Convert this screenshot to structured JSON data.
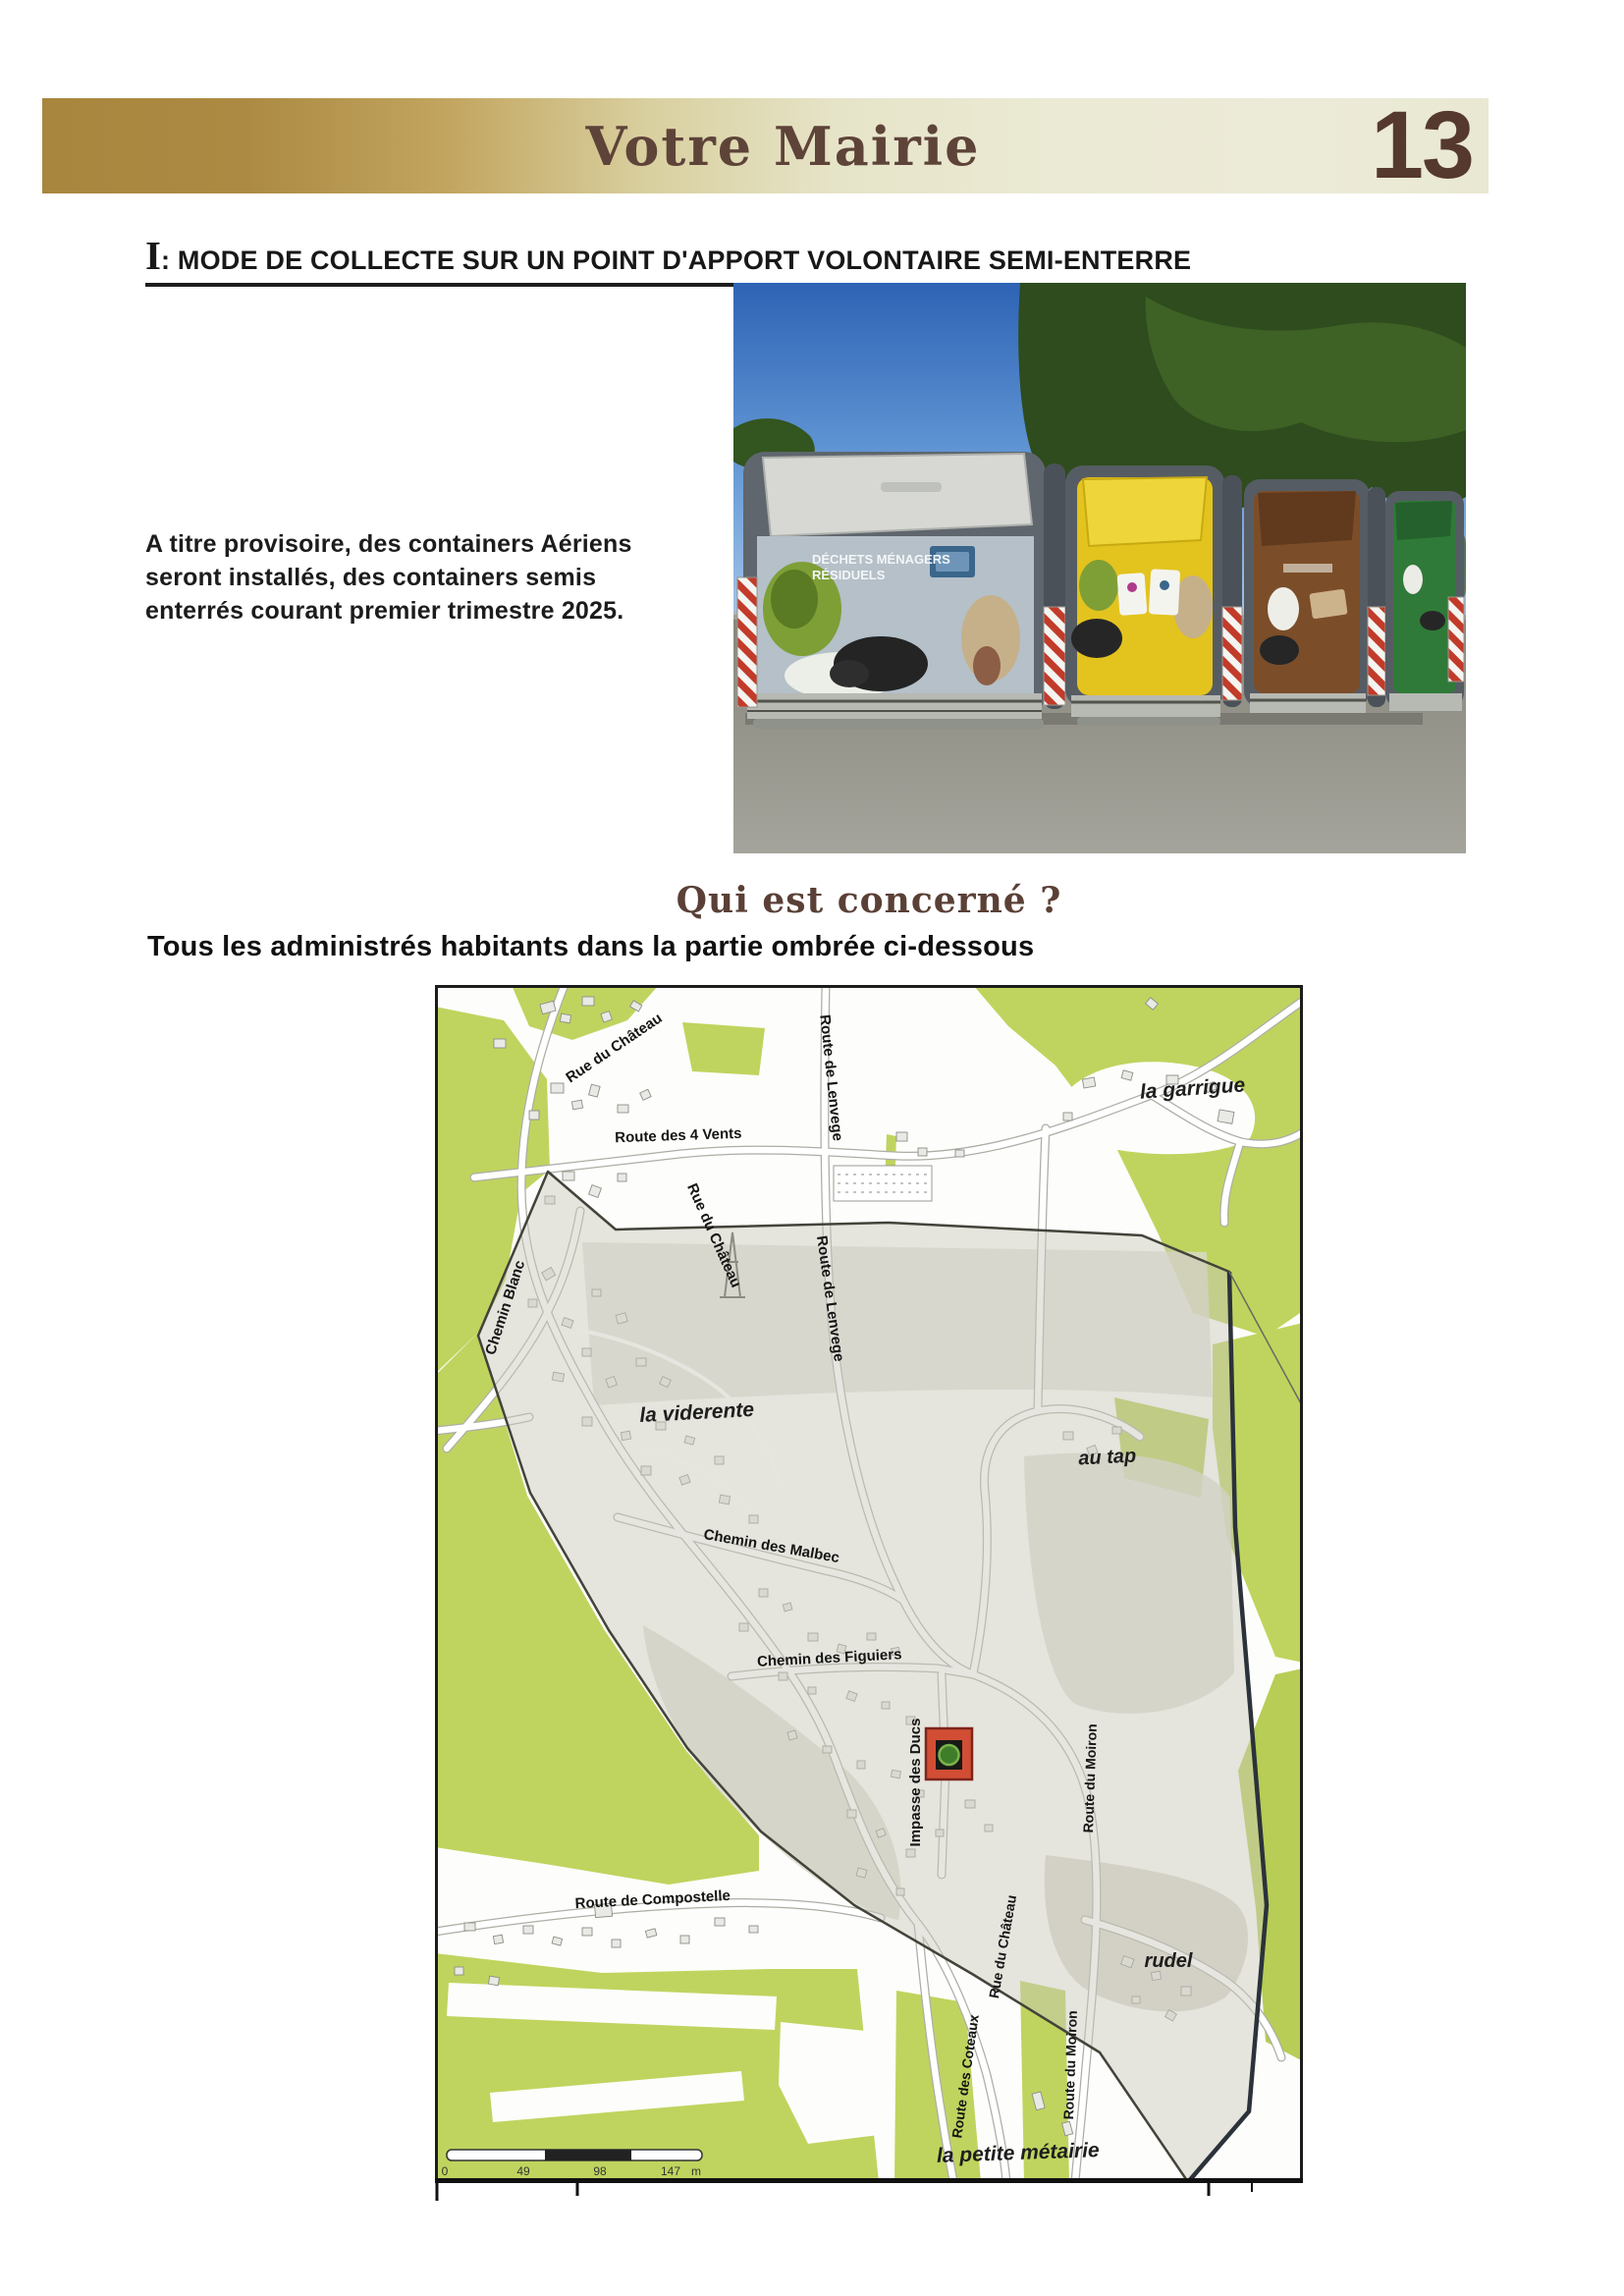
{
  "header": {
    "title": "Votre Mairie",
    "page_number": "13"
  },
  "section": {
    "numeral": "I",
    "separator": ": ",
    "heading": "MODE DE COLLECTE SUR UN POINT D'APPORT VOLONTAIRE SEMI-ENTERRE"
  },
  "intro": {
    "lines": [
      "A titre provisoire, des containers Aériens",
      "seront installés, des containers semis",
      "enterrés courant premier trimestre 2025."
    ]
  },
  "photo": {
    "description": "four semi-buried waste collection containers (grey, yellow, brown, green) on asphalt under blue sky",
    "bin1_label_line1": "DÉCHETS MÉNAGERS",
    "bin1_label_line2": "RÉSIDUELS"
  },
  "concerned": {
    "title": "Qui est concerné ?",
    "subtitle": "Tous les administrés habitants dans la partie ombrée ci-dessous"
  },
  "map": {
    "labels": [
      {
        "text": "Rue du Château",
        "kind": "street"
      },
      {
        "text": "Route de Lenvege",
        "kind": "street"
      },
      {
        "text": "la garrigue",
        "kind": "place"
      },
      {
        "text": "Route des 4 Vents",
        "kind": "street"
      },
      {
        "text": "Chemin Blanc",
        "kind": "street"
      },
      {
        "text": "Rue du Château",
        "kind": "street"
      },
      {
        "text": "la viderente",
        "kind": "place"
      },
      {
        "text": "Route de Lenvege",
        "kind": "street"
      },
      {
        "text": "au tap",
        "kind": "place"
      },
      {
        "text": "Chemin des Malbec",
        "kind": "street"
      },
      {
        "text": "Chemin des Figuiers",
        "kind": "street"
      },
      {
        "text": "Impasse des Ducs",
        "kind": "street"
      },
      {
        "text": "Rue du Château",
        "kind": "street"
      },
      {
        "text": "Route du Moiron",
        "kind": "street"
      },
      {
        "text": "Route des Coteaux",
        "kind": "street"
      },
      {
        "text": "Route du Moiron",
        "kind": "street"
      },
      {
        "text": "Route de Compostelle",
        "kind": "street"
      },
      {
        "text": "rudel",
        "kind": "place"
      },
      {
        "text": "la petite métairie",
        "kind": "place"
      }
    ],
    "scale": {
      "ticks": [
        "0",
        "49",
        "98",
        "147"
      ],
      "unit": "m"
    }
  },
  "colors": {
    "header_gold": "#a8863e",
    "header_pale": "#ecebd8",
    "title_brown": "#5e4339",
    "page_number_brown": "#55392f",
    "map_green": "#bfd45e",
    "shaded_zone": "#cbc9bc",
    "boundary": "#43433a",
    "marker_red": "#d14e35"
  }
}
